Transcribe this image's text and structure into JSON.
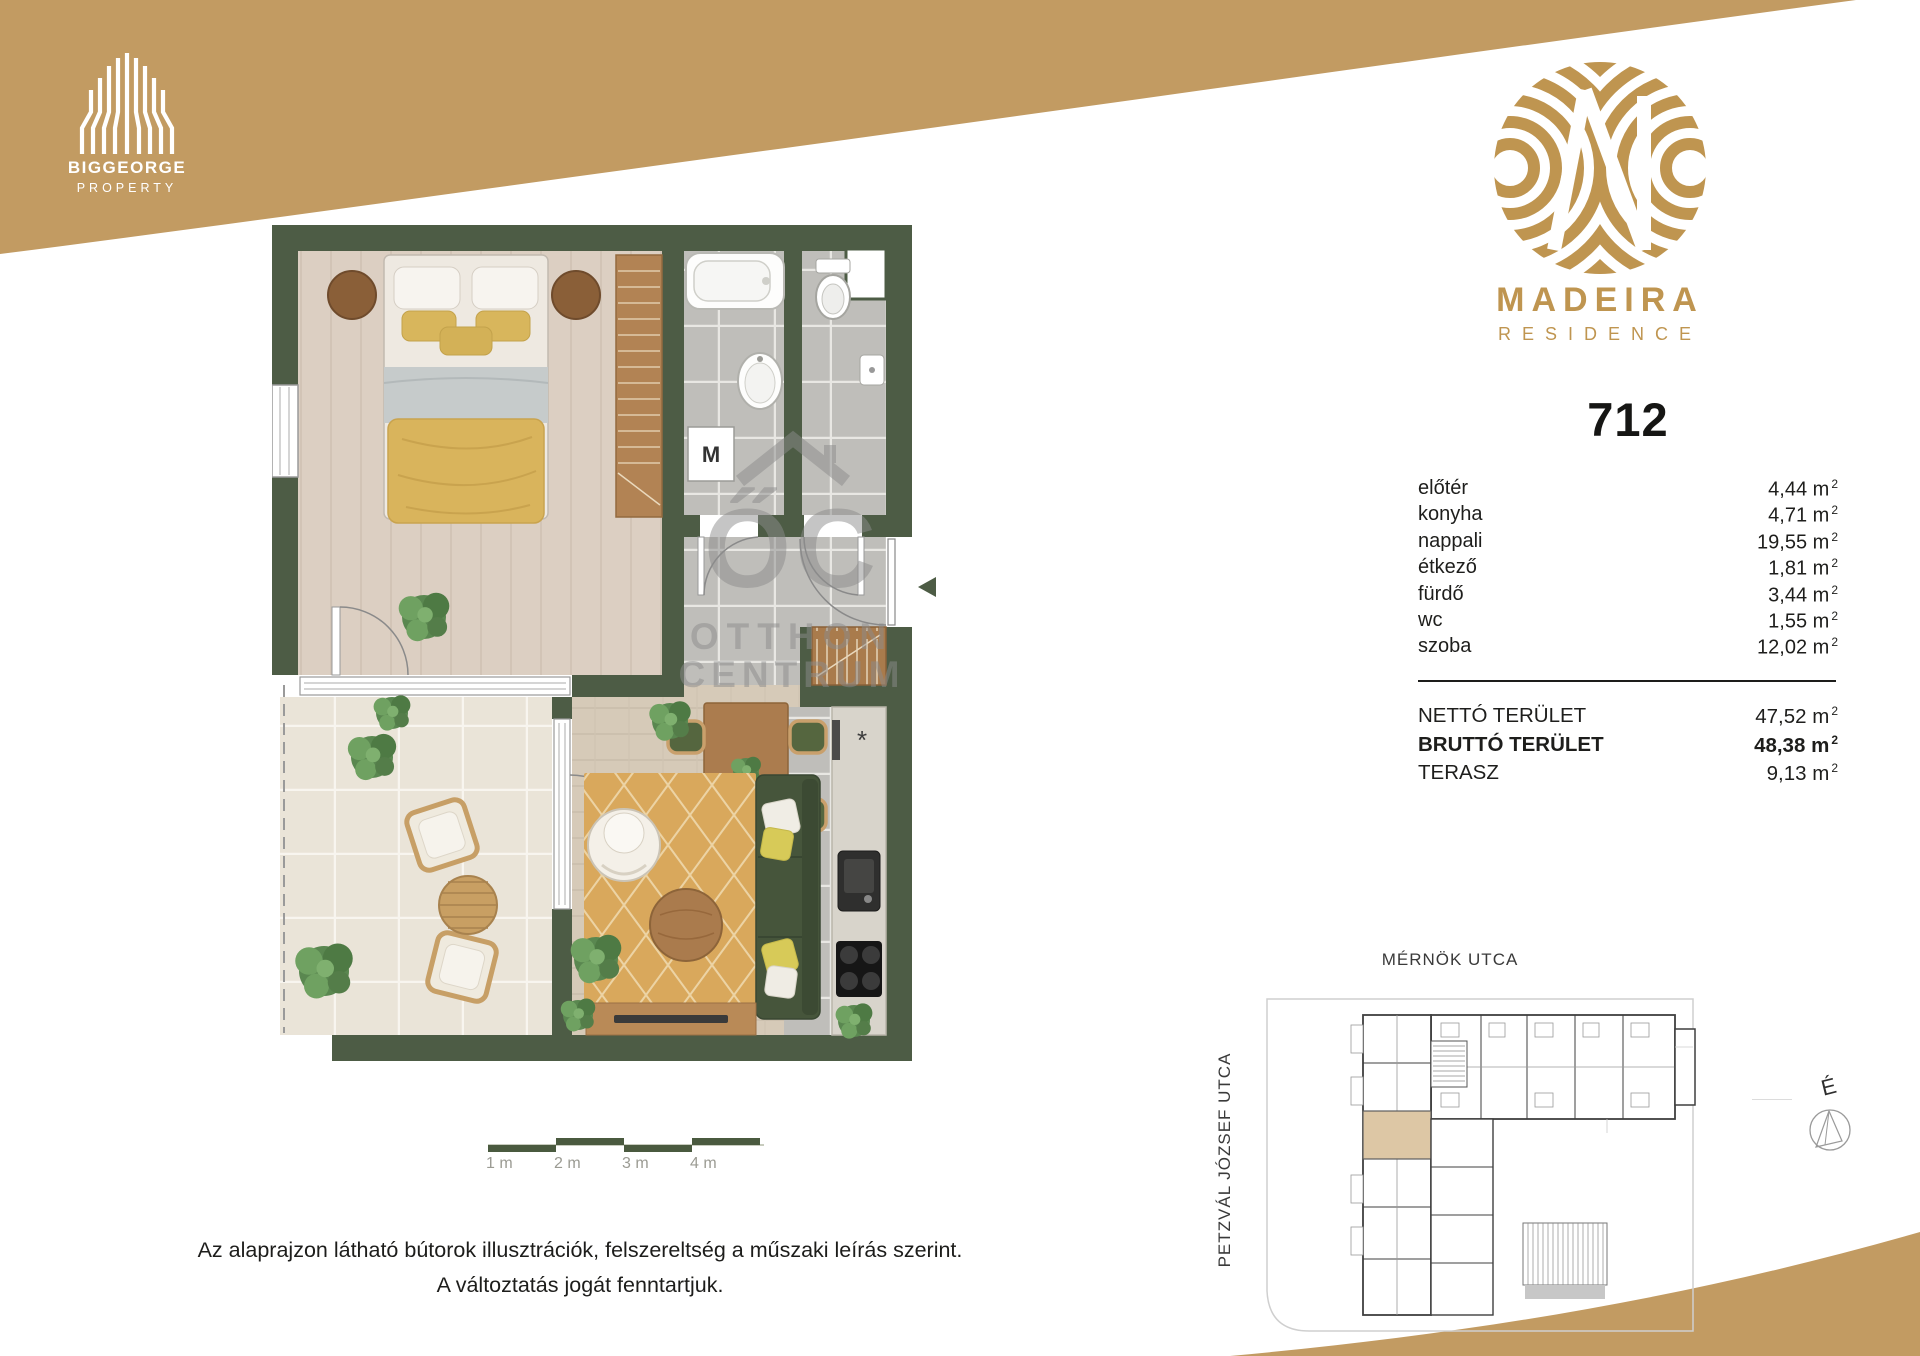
{
  "brand": {
    "biggeorge": {
      "name": "BIGGEORGE",
      "sub": "PROPERTY"
    },
    "madeira": {
      "name": "MADEIRA",
      "sub": "RESIDENCE"
    }
  },
  "unit": {
    "number": "712"
  },
  "areas": {
    "unit_suffix": "m",
    "unit_sup": "2",
    "rooms": [
      {
        "label": "előtér",
        "value": "4,44"
      },
      {
        "label": "konyha",
        "value": "4,71"
      },
      {
        "label": "nappali",
        "value": "19,55"
      },
      {
        "label": "étkező",
        "value": "1,81"
      },
      {
        "label": "fürdő",
        "value": "3,44"
      },
      {
        "label": "wc",
        "value": "1,55"
      },
      {
        "label": "szoba",
        "value": "12,02"
      }
    ],
    "totals": [
      {
        "label": "NETTÓ TERÜLET",
        "value": "47,52"
      },
      {
        "label": "BRUTTÓ TERÜLET",
        "value": "48,38"
      },
      {
        "label": "TERASZ",
        "value": "9,13"
      }
    ]
  },
  "floorplan": {
    "washer_label": "M",
    "star": "*"
  },
  "watermark": {
    "initials": "ŐC",
    "line1": "OTTHON",
    "line2": "CENTRUM"
  },
  "siteplan": {
    "street_top": "MÉRNÖK UTCA",
    "street_left": "PETZVÁL JÓZSEF UTCA",
    "north": "É"
  },
  "scalebar": {
    "labels": [
      "1 m",
      "2 m",
      "3 m",
      "4 m"
    ]
  },
  "disclaimer": {
    "line1": "Az alaprajzon látható bútorok illusztrációk, felszereltség a műszaki leírás szerint.",
    "line2": "A változtatás jogát fenntartjuk."
  },
  "colors": {
    "gold": "#c29b62",
    "logo_gold": "#bf9550",
    "wall_green": "#4d5c45",
    "text": "#1e1e1c"
  }
}
